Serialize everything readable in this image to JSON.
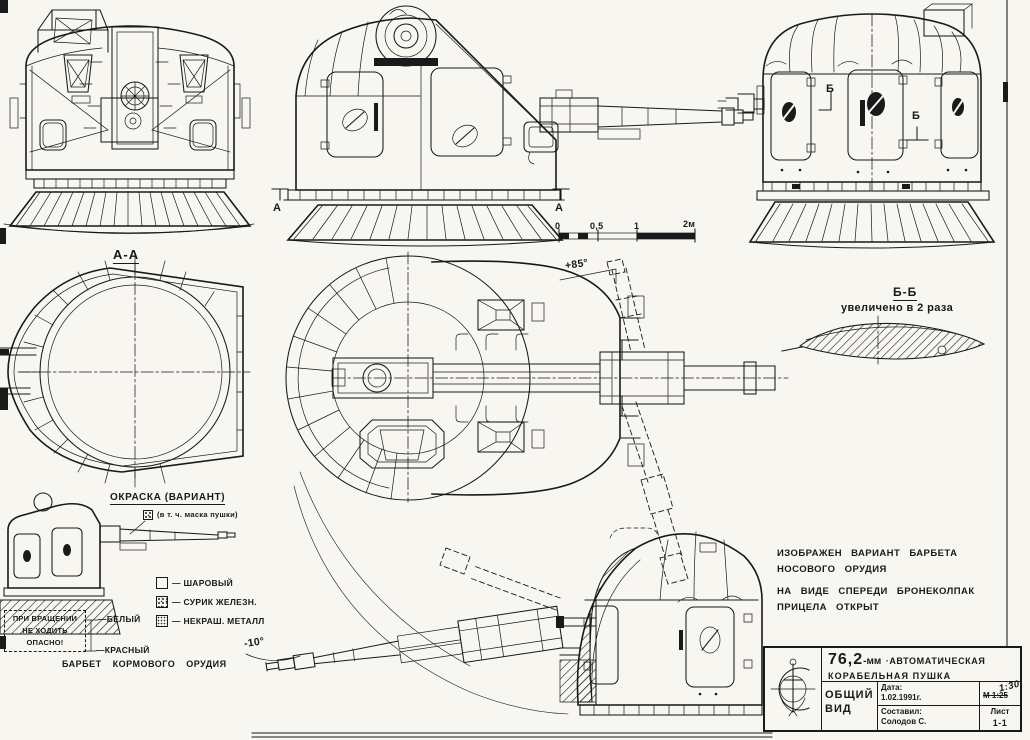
{
  "sheet": {
    "paper": "#f7f6f1",
    "ink": "#191919"
  },
  "markers": {
    "section_a": "А",
    "section_b": "Б",
    "section_aa_title": "А-А",
    "section_bb_title": "Б-Б",
    "bb_note": "увеличено в 2 раза",
    "elev_up": "+85°",
    "elev_down": "-10°"
  },
  "scale_bar": {
    "ticks": [
      "0",
      "0,5",
      "1",
      "2м"
    ]
  },
  "paint": {
    "title": "ОКРАСКА (ВАРИАНТ)",
    "mask_note": "(в т. ч. маска пушки)",
    "legend": [
      {
        "style": "plain",
        "label": "— ШАРОВЫЙ"
      },
      {
        "style": "stipple",
        "label": "— СУРИК ЖЕЛЕЗН."
      },
      {
        "style": "dots",
        "label": "— НЕКРАШ. МЕТАЛЛ"
      }
    ],
    "white_label": "—БЕЛЫЙ",
    "red_label": "—КРАСНЫЙ",
    "warning": [
      "ПРИ ВРАЩЕНИИ",
      "НЕ ХОДИТЬ",
      "ОПАСНО!"
    ],
    "caption": "БАРБЕТ КОРМОВОГО ОРУДИЯ"
  },
  "notes": {
    "line1": "ИЗОБРАЖЕН ВАРИАНТ БАРБЕТА НОСОВОГО ОРУДИЯ",
    "line2": "НА ВИДЕ СПЕРЕДИ БРОНЕКОЛПАК ПРИЦЕЛА ОТКРЫТ"
  },
  "title_block": {
    "caliber": "76,2",
    "caliber_unit": "-мм",
    "name1": "·АВТОМАТИЧЕСКАЯ",
    "name2": "КОРАБЕЛЬНАЯ ПУШКА",
    "date_label": "Дата:",
    "date": "1.02.1991г.",
    "view_type": "ОБЩИЙ ВИД",
    "scale_struck": "М 1:25",
    "scale_hand": "1:30",
    "author_label": "Составил:",
    "author": "Солодов С.",
    "sheet_label": "Лист",
    "sheet_no": "1-1"
  }
}
